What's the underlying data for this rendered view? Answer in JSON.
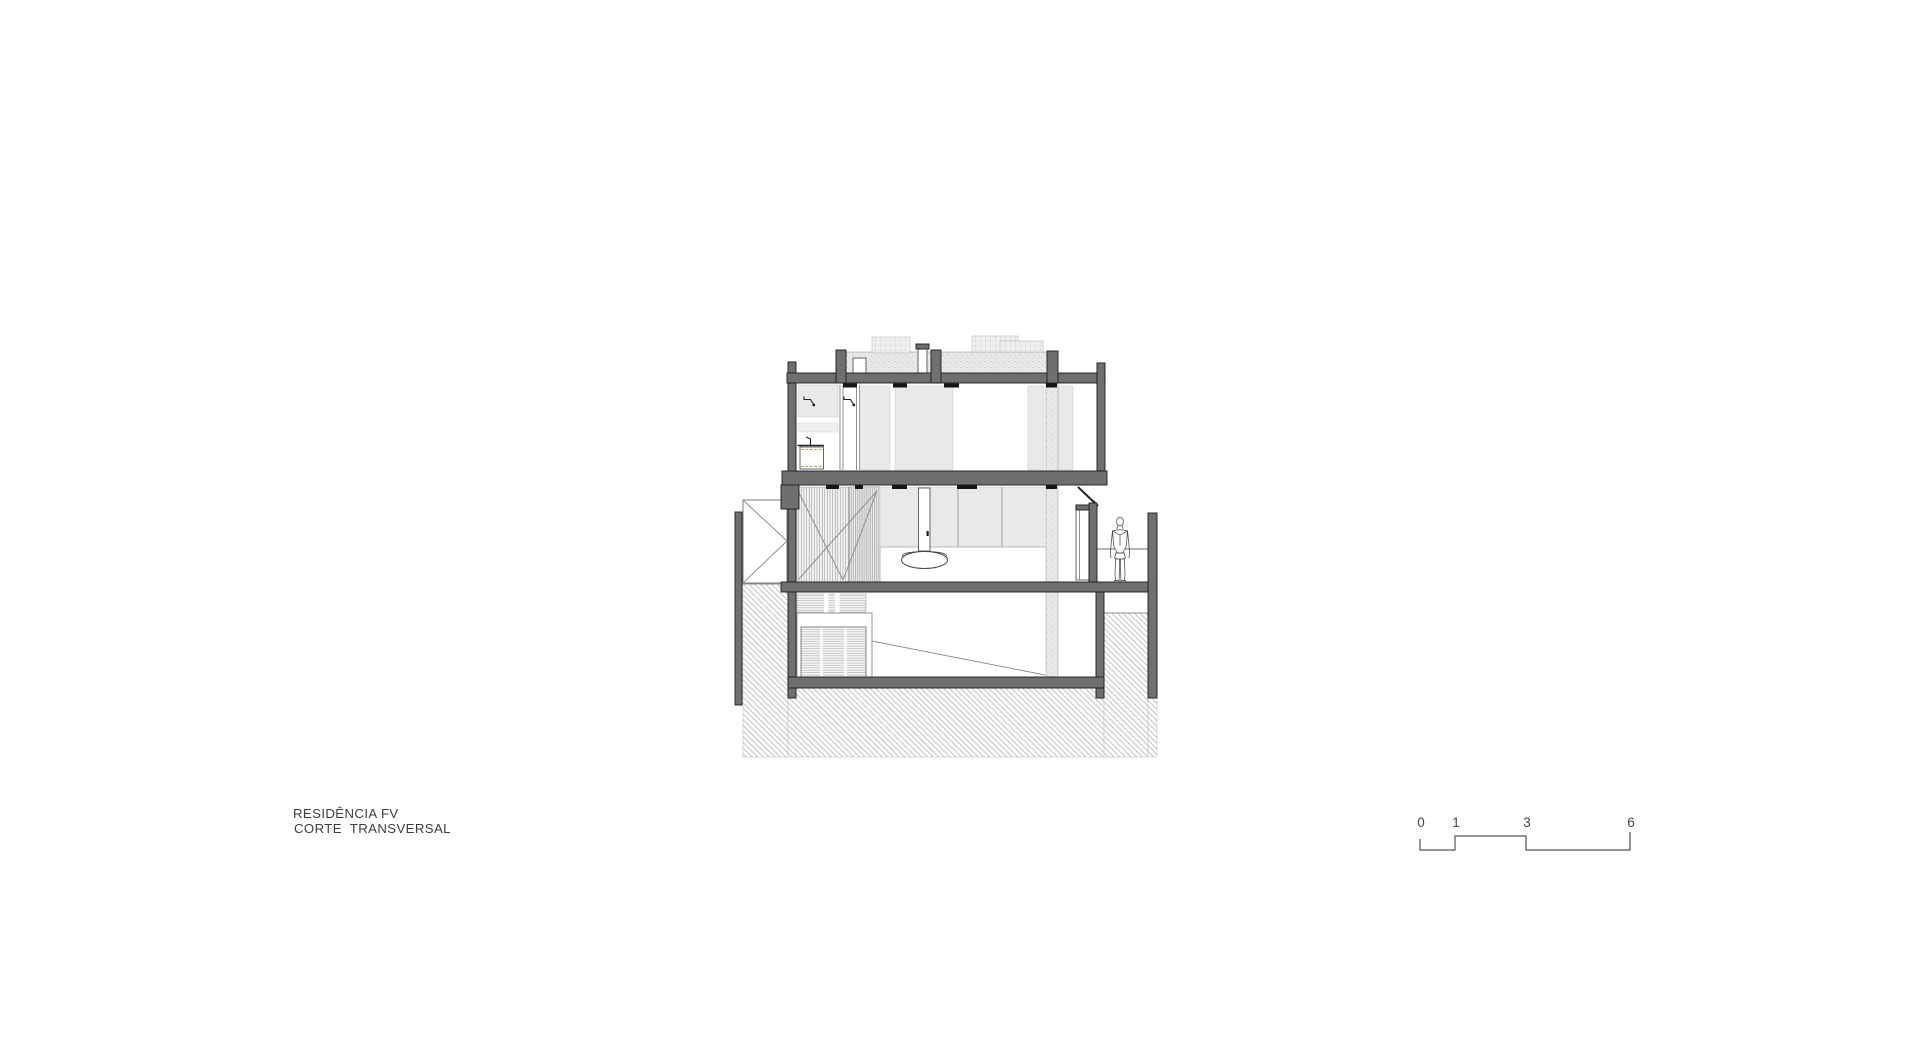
{
  "canvas": {
    "width": 1920,
    "height": 1043,
    "background": "#ffffff"
  },
  "title_block": {
    "project_name": "RESIDÊNCIA FV",
    "drawing_name": "CORTE TRANSVERSAL"
  },
  "scale_bar": {
    "labels": [
      "0",
      "1",
      "3",
      "6"
    ],
    "style": "stepped graphic scale, meters"
  },
  "palette": {
    "sheet_background": "#ffffff",
    "cut_wall_gray": "#6f6f6f",
    "outline_dark": "#1b1b1b",
    "glass_panel_gray": "#e9e9e9",
    "texture_line_gray": "#8f8f8f",
    "ground_hatch_gray": "#b3b3b3",
    "cabinet_dash_tan": "#b8973f"
  },
  "drawing": {
    "type": "architectural cross-section",
    "levels": [
      "roof with planted terrace",
      "upper floor with bathroom and bedroom",
      "ground floor living room with terrace",
      "basement garage"
    ],
    "elements": [
      "green-roof mounds",
      "chimney",
      "roof vent box",
      "shower arms",
      "vanity cabinet",
      "glazed facade panels",
      "slatted screen wall",
      "pendant lamp",
      "garage swing door",
      "louvered vents",
      "ramp line",
      "terrace guardrail",
      "human figure",
      "ground hatch"
    ]
  }
}
